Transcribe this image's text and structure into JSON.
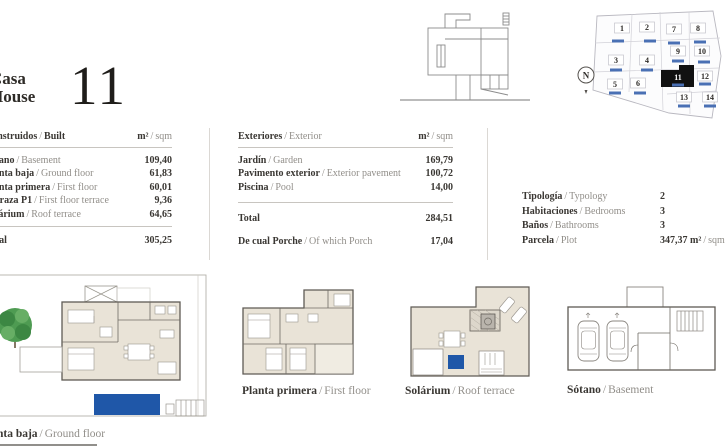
{
  "ui": {
    "sep": "/"
  },
  "header": {
    "title_es": "Casa",
    "title_en": "House",
    "number": "11"
  },
  "tables": {
    "built": {
      "title": {
        "es": "Construidos",
        "en": "Built"
      },
      "unit": {
        "es": "m²",
        "en": "sqm"
      },
      "rows": [
        {
          "es": "Sótano",
          "en": "Basement",
          "value": "109,40"
        },
        {
          "es": "Planta baja",
          "en": "Ground floor",
          "value": "61,83"
        },
        {
          "es": "Planta primera",
          "en": "First floor",
          "value": "60,01"
        },
        {
          "es": "Terraza P1",
          "en": "First floor terrace",
          "value": "9,36"
        },
        {
          "es": "Solárium",
          "en": "Roof terrace",
          "value": "64,65"
        }
      ],
      "total_label": "Total",
      "total_value": "305,25"
    },
    "exterior": {
      "title": {
        "es": "Exteriores",
        "en": "Exterior"
      },
      "unit": {
        "es": "m²",
        "en": "sqm"
      },
      "rows": [
        {
          "es": "Jardín",
          "en": "Garden",
          "value": "169,79"
        },
        {
          "es": "Pavimento exterior",
          "en": "Exterior pavement",
          "value": "100,72"
        },
        {
          "es": "Piscina",
          "en": "Pool",
          "value": "14,00"
        }
      ],
      "total_label": "Total",
      "total_value": "284,51",
      "porch": {
        "es": "De cual Porche",
        "en": "Of which Porch",
        "value": "17,04"
      }
    },
    "info": {
      "rows": [
        {
          "es": "Tipología",
          "en": "Typology",
          "value": "2"
        },
        {
          "es": "Habitaciones",
          "en": "Bedrooms",
          "value": "3"
        },
        {
          "es": "Baños",
          "en": "Bathrooms",
          "value": "3"
        },
        {
          "es": "Parcela",
          "en": "Plot",
          "value": "347,37",
          "unit_es": "m²",
          "unit_en": "sqm"
        }
      ]
    }
  },
  "plans": [
    {
      "es": "Planta baja",
      "en": "Ground floor"
    },
    {
      "es": "Planta primera",
      "en": "First floor"
    },
    {
      "es": "Solárium",
      "en": "Roof terrace"
    },
    {
      "es": "Sótano",
      "en": "Basement"
    }
  ],
  "sitemap": {
    "north": "N",
    "selected": "11",
    "plots": [
      "1",
      "2",
      "7",
      "8",
      "3",
      "4",
      "9",
      "10",
      "5",
      "6",
      "11",
      "12",
      "13",
      "14"
    ]
  },
  "colors": {
    "pool_blue": "#1f57a8",
    "bar_blue": "#4a70b4",
    "selected_plot": "#111111",
    "room_beige": "#e9e3d7",
    "tree_green": "#4e9b52"
  }
}
